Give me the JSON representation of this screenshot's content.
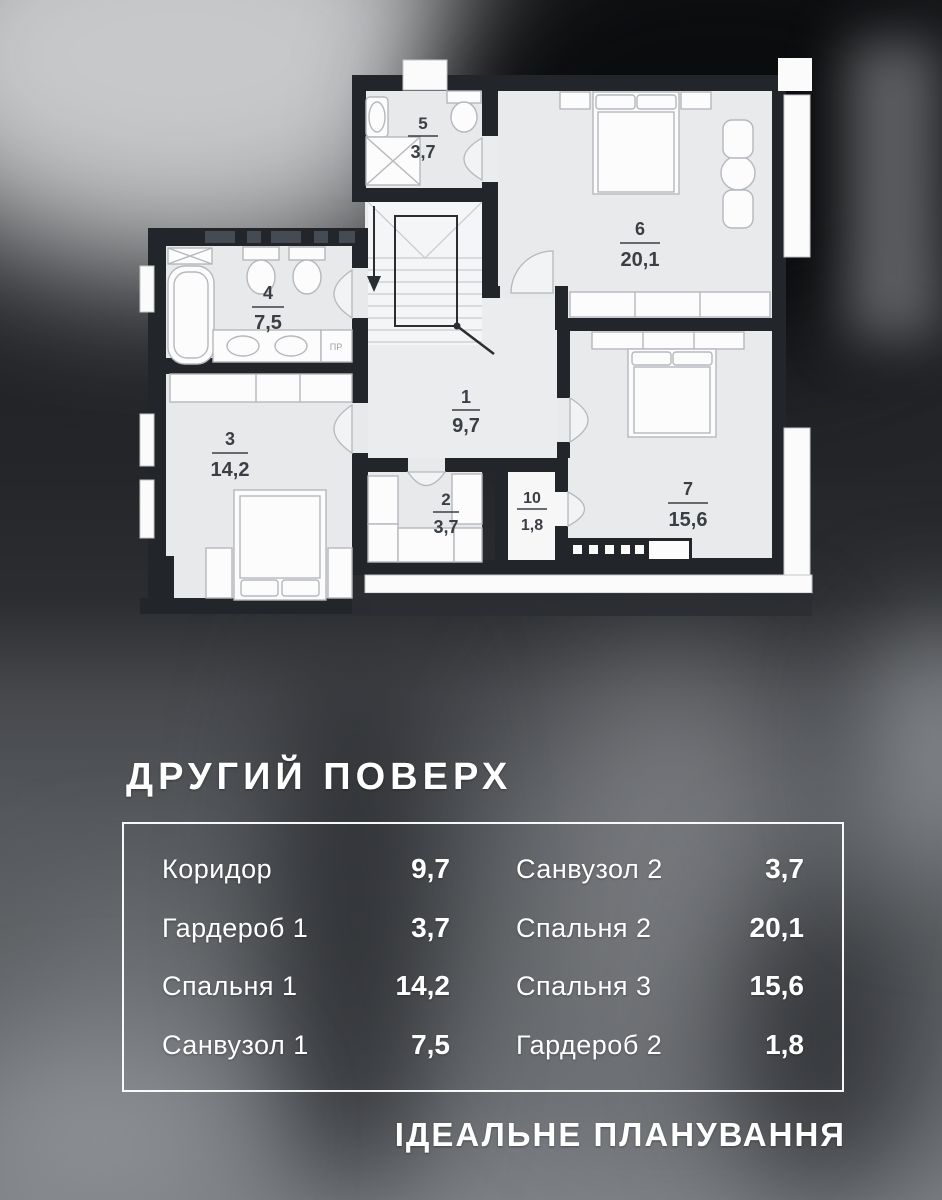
{
  "title": "ДРУГИЙ ПОВЕРХ",
  "footer": "ІДЕАЛЬНЕ ПЛАНУВАННЯ",
  "table": {
    "rows_left": [
      {
        "label": "Коридор",
        "value": "9,7"
      },
      {
        "label": "Гардероб 1",
        "value": "3,7"
      },
      {
        "label": "Спальня 1",
        "value": "14,2"
      },
      {
        "label": "Санвузол 1",
        "value": "7,5"
      }
    ],
    "rows_right": [
      {
        "label": "Санвузол 2",
        "value": "3,7"
      },
      {
        "label": "Спальня 2",
        "value": "20,1"
      },
      {
        "label": "Спальня 3",
        "value": "15,6"
      },
      {
        "label": "Гардероб 2",
        "value": "1,8"
      }
    ]
  },
  "plan": {
    "rooms": [
      {
        "num": "1",
        "area": "9,7"
      },
      {
        "num": "2",
        "area": "3,7"
      },
      {
        "num": "3",
        "area": "14,2"
      },
      {
        "num": "4",
        "area": "7,5"
      },
      {
        "num": "5",
        "area": "3,7"
      },
      {
        "num": "6",
        "area": "20,1"
      },
      {
        "num": "7",
        "area": "15,6"
      },
      {
        "num": "10",
        "area": "1,8"
      }
    ],
    "washer_label": "ПР"
  },
  "colors": {
    "wall": "#22252a",
    "room_fill": "#e8e9ea",
    "text_on_dark": "#ffffff",
    "plan_label": "#3b3f45"
  }
}
